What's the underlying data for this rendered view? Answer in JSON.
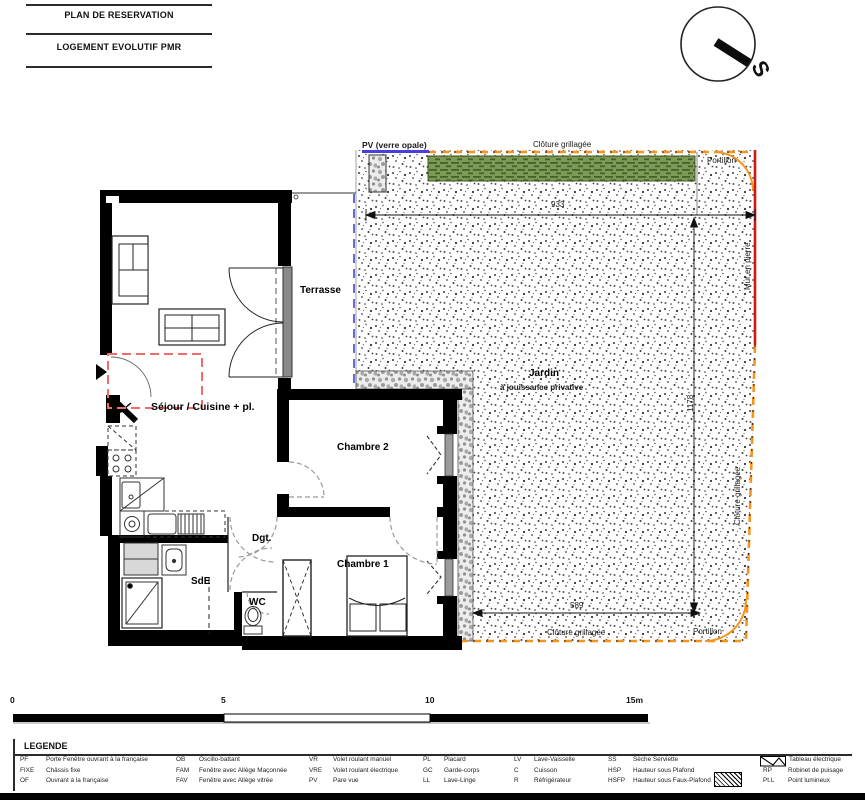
{
  "header": {
    "title_line1": "PLAN DE RESERVATION",
    "title_line2": "LOGEMENT EVOLUTIF PMR",
    "compass_letter": "S"
  },
  "plan": {
    "rooms": {
      "terrasse": "Terrasse",
      "sejour": "Séjour / Cuisine + pl.",
      "chambre2": "Chambre 2",
      "chambre1": "Chambre 1",
      "dgt": "Dgt.",
      "sde": "SdE",
      "wc": "WC",
      "jardin": "Jardin",
      "jardin_sub": "à jouissance privative"
    },
    "site": {
      "pv": "PV (verre opale)",
      "cloture_top": "Clôture grillagée",
      "cloture_right": "Clôture grillagée",
      "cloture_bottom": "Clôture grillagée",
      "portillon_top": "Portillon",
      "portillon_bottom": "Portillon",
      "mur_en_pierre": "Mur en pierre"
    },
    "dimensions": {
      "top": "933",
      "right": "1178",
      "bottom": "589"
    }
  },
  "scalebar": {
    "t0": "0",
    "t5": "5",
    "t10": "10",
    "t15": "15m"
  },
  "legend": {
    "title": "LEGENDE",
    "columns": [
      {
        "items": [
          {
            "abbr": "PF",
            "label": "Porte Fenêtre ouvrant à la française"
          },
          {
            "abbr": "FIXE",
            "label": "Châssis fixe"
          },
          {
            "abbr": "OF",
            "label": "Ouvrant à la française"
          }
        ]
      },
      {
        "items": [
          {
            "abbr": "OB",
            "label": "Oscillo-battant"
          },
          {
            "abbr": "FAM",
            "label": "Fenêtre avec Allège Maçonnée"
          },
          {
            "abbr": "FAV",
            "label": "Fenêtre avec Allège vitrée"
          }
        ]
      },
      {
        "items": [
          {
            "abbr": "VR",
            "label": "Volet roulant manuel"
          },
          {
            "abbr": "VRE",
            "label": "Volet roulant électrique"
          },
          {
            "abbr": "PV",
            "label": "Pare vue"
          }
        ]
      },
      {
        "items": [
          {
            "abbr": "PL",
            "label": "Placard"
          },
          {
            "abbr": "GC",
            "label": "Garde-corps"
          },
          {
            "abbr": "LL",
            "label": "Lave-Linge"
          }
        ]
      },
      {
        "items": [
          {
            "abbr": "LV",
            "label": "Lave-Vaisselle"
          },
          {
            "abbr": "C",
            "label": "Cuisson"
          },
          {
            "abbr": "R",
            "label": "Réfrigérateur"
          }
        ]
      },
      {
        "items": [
          {
            "abbr": "SS",
            "label": "Sèche Serviette"
          },
          {
            "abbr": "HSP",
            "label": "Hauteur sous Plafond"
          },
          {
            "abbr": "HSFP",
            "label": "Hauteur sous Faux-Plafond"
          }
        ]
      },
      {
        "items": [
          {
            "abbr": "",
            "label": "Tableau électrique"
          },
          {
            "abbr": "RP",
            "label": "Robinet de puisage"
          },
          {
            "abbr": "Pt.L",
            "label": "Point lumineux"
          }
        ]
      }
    ]
  },
  "colors": {
    "fence_orange": "#F7941D",
    "stone_wall_red": "#D01818",
    "pv_screen_blue": "#4A3FD8",
    "terrace_limit_blue": "#3A3ACB",
    "evolutive_zone_red": "#F26B6B",
    "hedge_green_dark": "#44622A",
    "hedge_green_light": "#7E9B56"
  }
}
